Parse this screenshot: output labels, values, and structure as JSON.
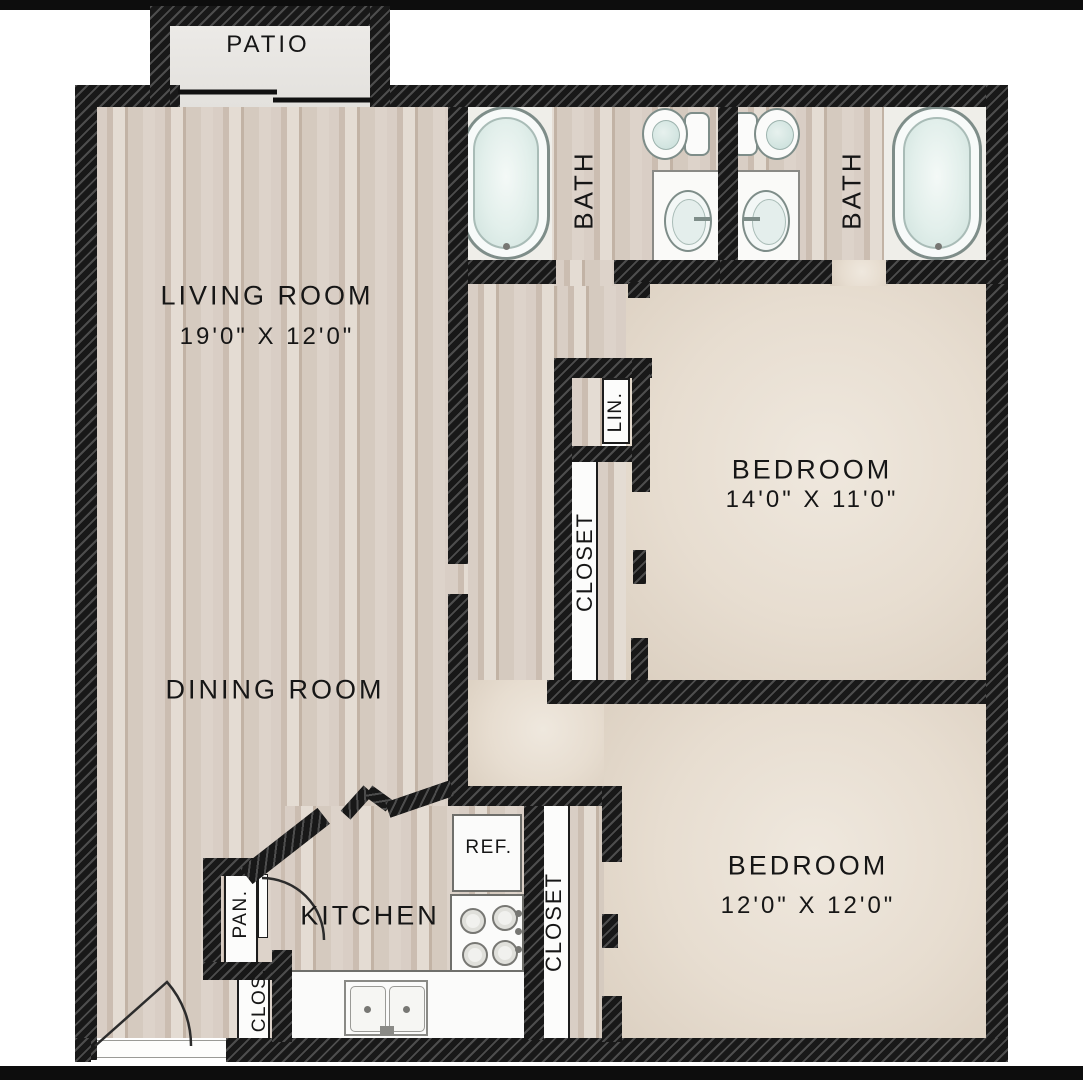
{
  "plan_title": "Two bedroom two bath floor plan",
  "rooms": {
    "patio": {
      "label": "PATIO"
    },
    "living_room": {
      "label": "LIVING ROOM",
      "dims": "19'0\" X 12'0\""
    },
    "dining_room": {
      "label": "DINING ROOM"
    },
    "kitchen": {
      "label": "KITCHEN"
    },
    "bath_1": {
      "label": "BATH"
    },
    "bath_2": {
      "label": "BATH"
    },
    "bedroom_1": {
      "label": "BEDROOM",
      "dims": "14'0\" X 11'0\""
    },
    "bedroom_2": {
      "label": "BEDROOM",
      "dims": "12'0\" X 12'0\""
    },
    "linen_closet": {
      "label": "LIN."
    },
    "closet_1": {
      "label": "CLOSET"
    },
    "closet_2": {
      "label": "CLOSET"
    },
    "pantry": {
      "label": "PAN."
    },
    "entry_closet": {
      "label": "CLOS."
    },
    "refrigerator": {
      "label": "REF."
    }
  },
  "colors": {
    "wall": "#181818",
    "wall_hatch": "#4d4d4d",
    "wood_floor": "#d5cabf",
    "room_floor": "#e7ddd0",
    "fixture_teal": "#cfe2dd",
    "background": "#ffffff"
  }
}
